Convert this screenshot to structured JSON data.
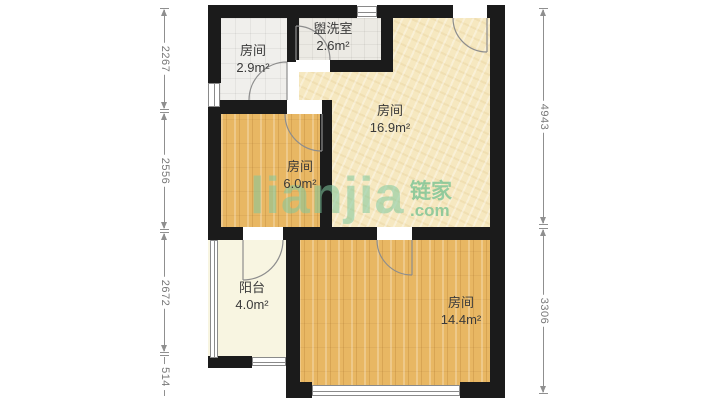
{
  "plan": {
    "title": "户型图",
    "rooms": [
      {
        "id": "bedroom-small",
        "label": "房间",
        "area": "2.9m²"
      },
      {
        "id": "washroom",
        "label": "盥洗室",
        "area": "2.6m²"
      },
      {
        "id": "living-room",
        "label": "房间",
        "area": "16.9m²"
      },
      {
        "id": "bedroom-mid",
        "label": "房间",
        "area": "6.0m²"
      },
      {
        "id": "balcony",
        "label": "阳台",
        "area": "4.0m²"
      },
      {
        "id": "bedroom-large",
        "label": "房间",
        "area": "14.4m²"
      }
    ],
    "dimensions": {
      "left": [
        "2267",
        "2556",
        "2672",
        "514"
      ],
      "right": [
        "4943",
        "3306"
      ]
    },
    "watermark": {
      "logo": "lianjia",
      "cjk": "链家",
      "domain": ".com"
    },
    "colors": {
      "wall": "#1b1b1b",
      "wood_floor": "#e8b763",
      "cream_floor": "#f6e8c0",
      "balcony_floor": "#f8f5e1",
      "tile_floor": "#f0efec",
      "watermark_green": "#7cc79b",
      "dimension_gray": "#8f8f8f"
    }
  }
}
